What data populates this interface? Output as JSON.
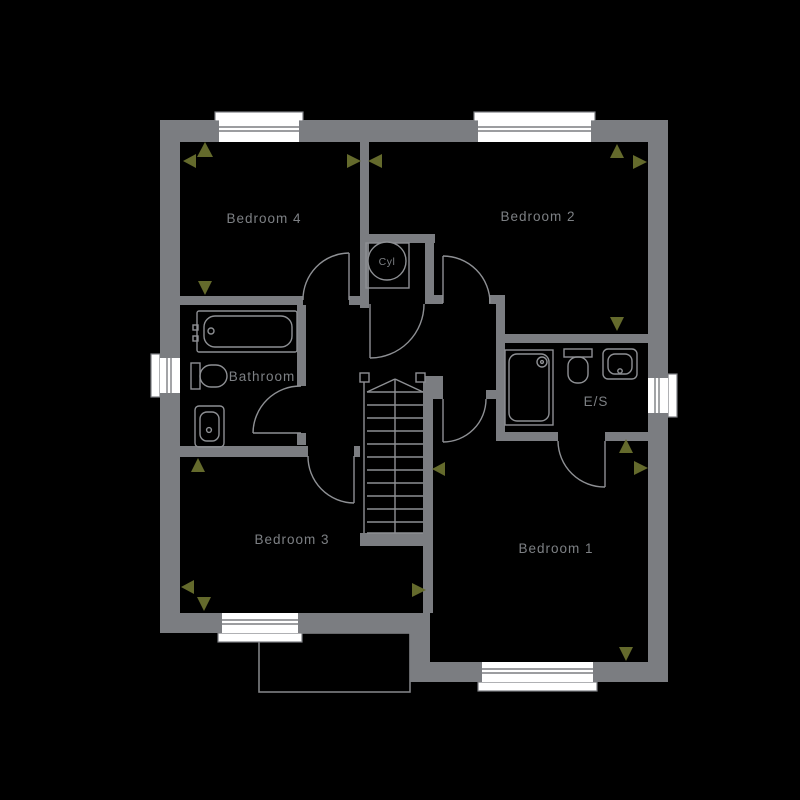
{
  "plan": {
    "type": "floor-plan",
    "rooms": {
      "bedroom4": {
        "label": "Bedroom 4"
      },
      "bedroom2": {
        "label": "Bedroom 2"
      },
      "bedroom3": {
        "label": "Bedroom 3"
      },
      "bedroom1": {
        "label": "Bedroom 1"
      },
      "bathroom": {
        "label": "Bathroom"
      },
      "ensuite": {
        "label": "E/S"
      },
      "cylinder": {
        "label": "Cyl"
      }
    },
    "colors": {
      "background": "#000000",
      "wall": "#7b7d81",
      "fixture_line": "#8e9094",
      "window_fill": "#ffffff",
      "label_text": "#7d8084",
      "dimension_marker": "#646a2c"
    }
  }
}
